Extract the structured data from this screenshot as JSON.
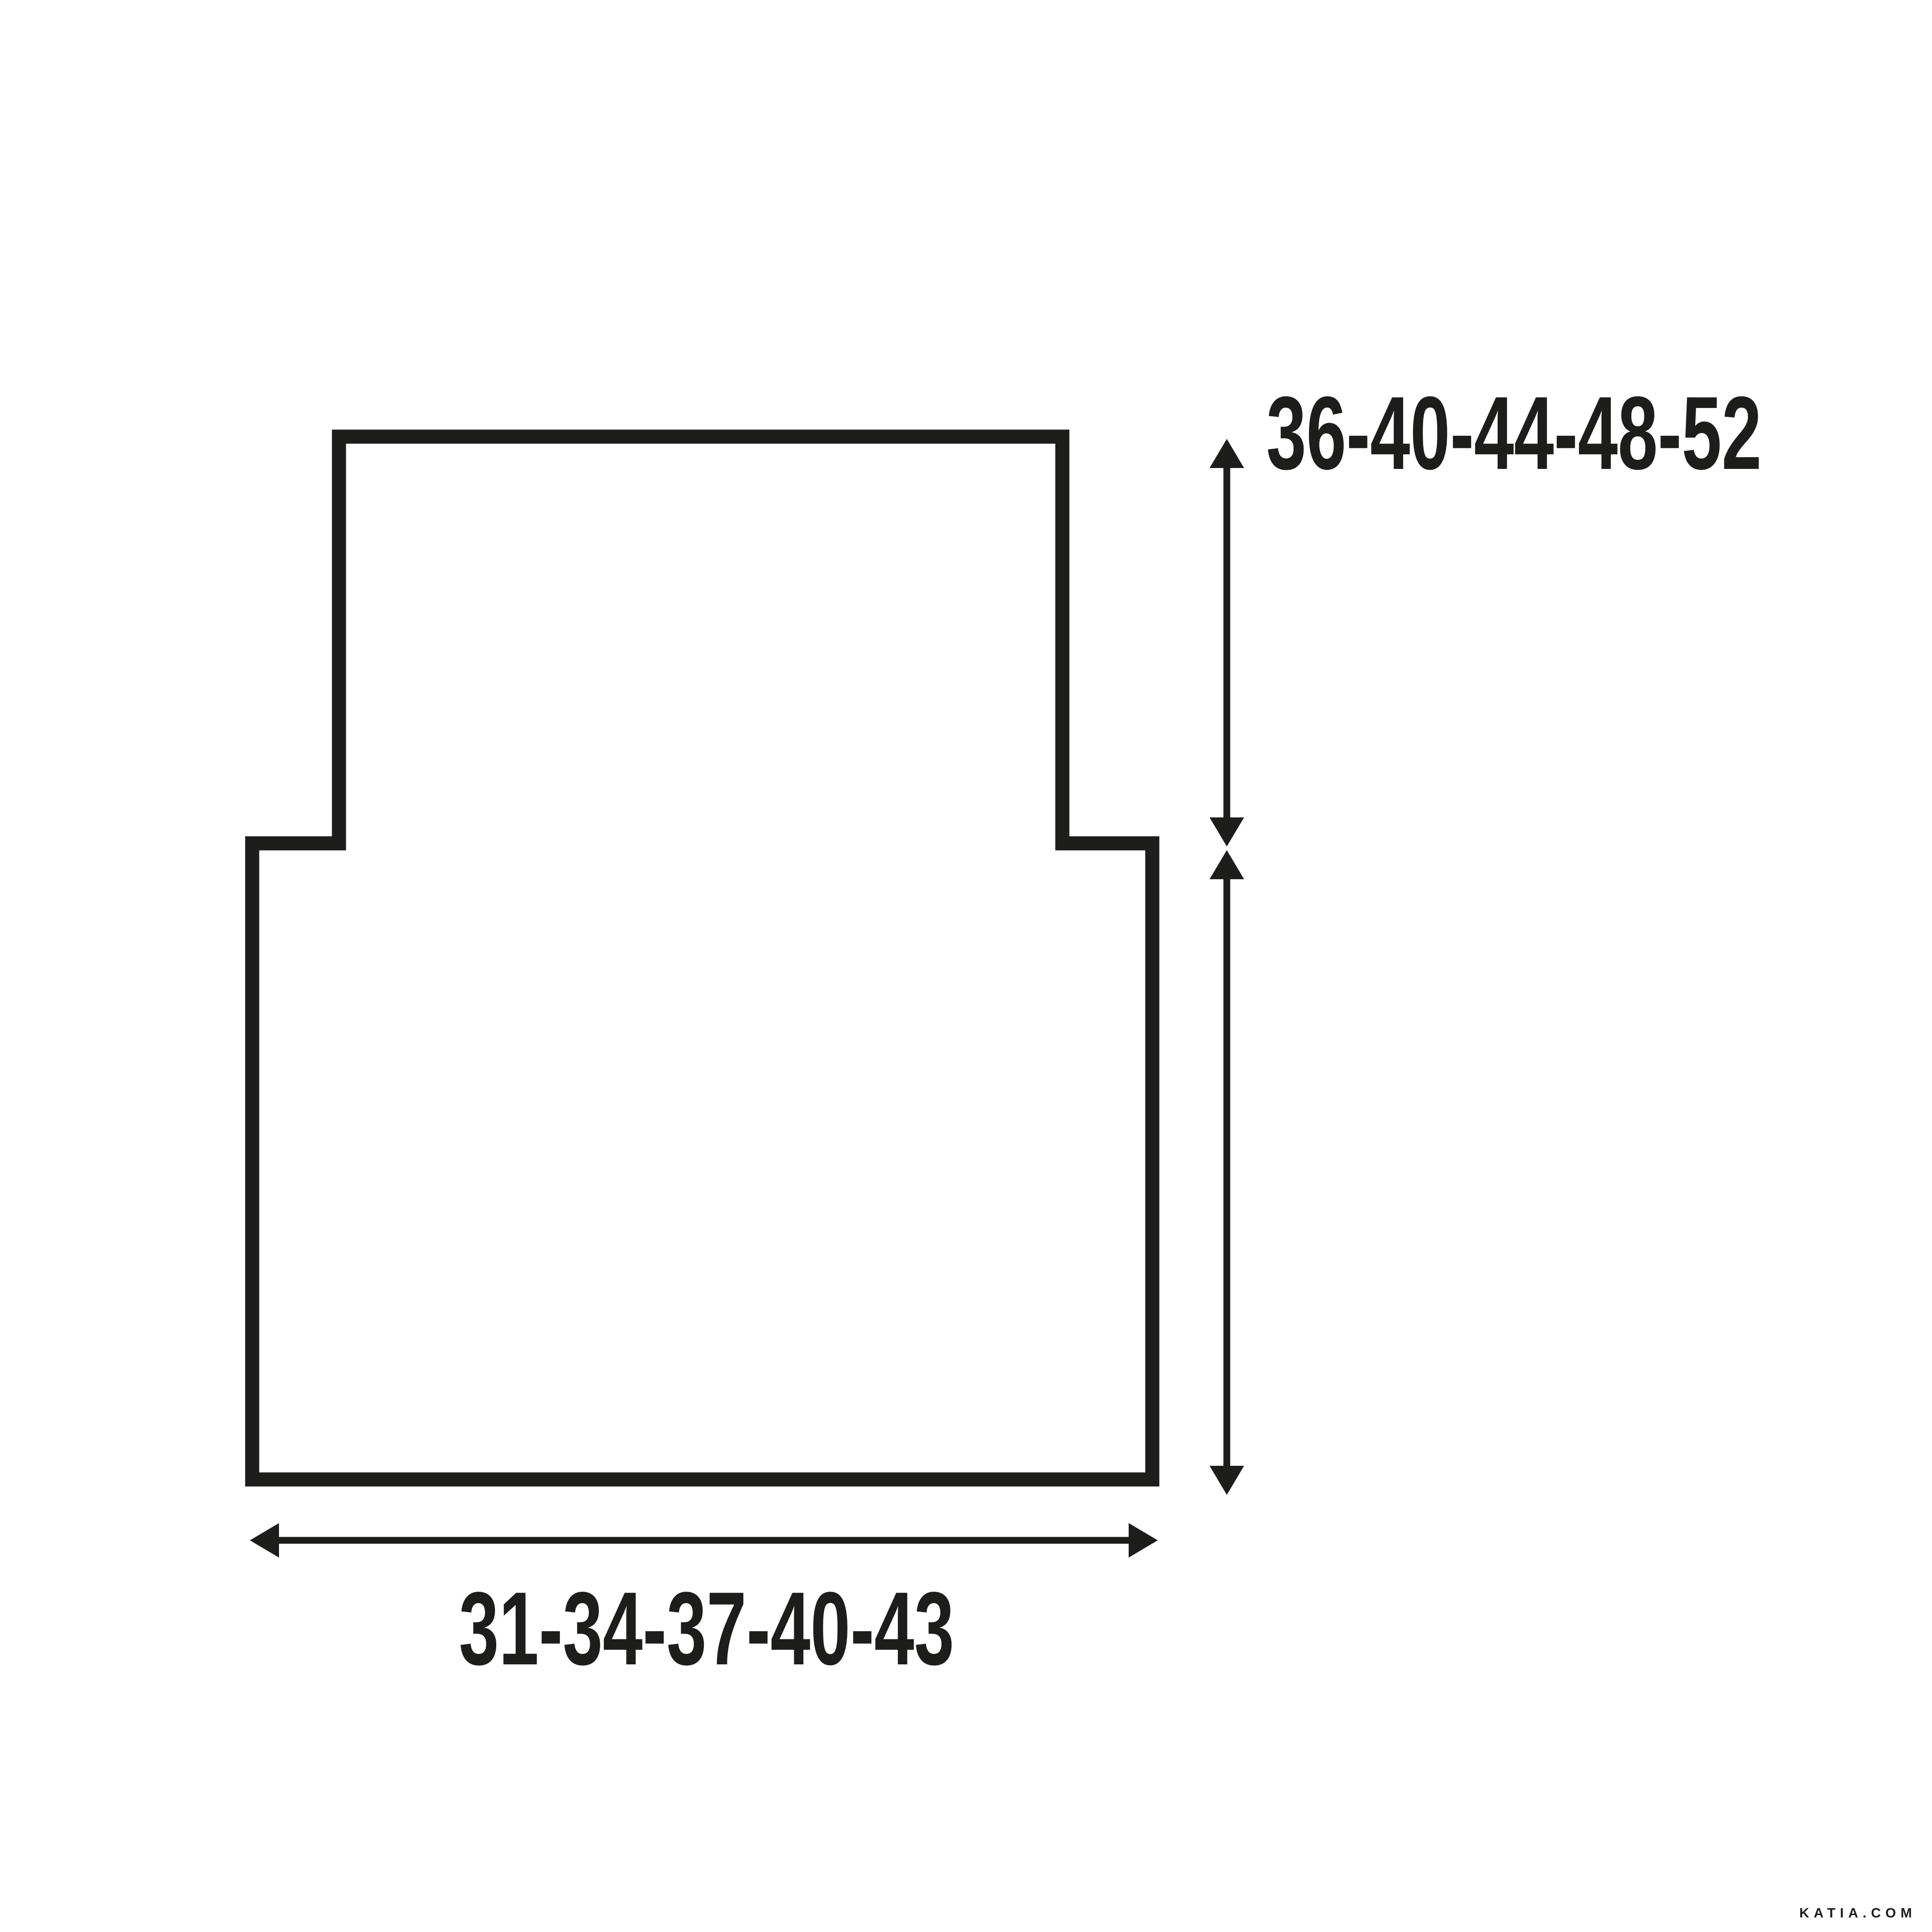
{
  "diagram": {
    "vertical_measurement_label": "36-40-44-48-52",
    "horizontal_measurement_label": "31-34-37-40-43"
  },
  "watermark": "KATIA.COM",
  "colors": {
    "line": "#1d1d1b",
    "background": "#ffffff"
  }
}
